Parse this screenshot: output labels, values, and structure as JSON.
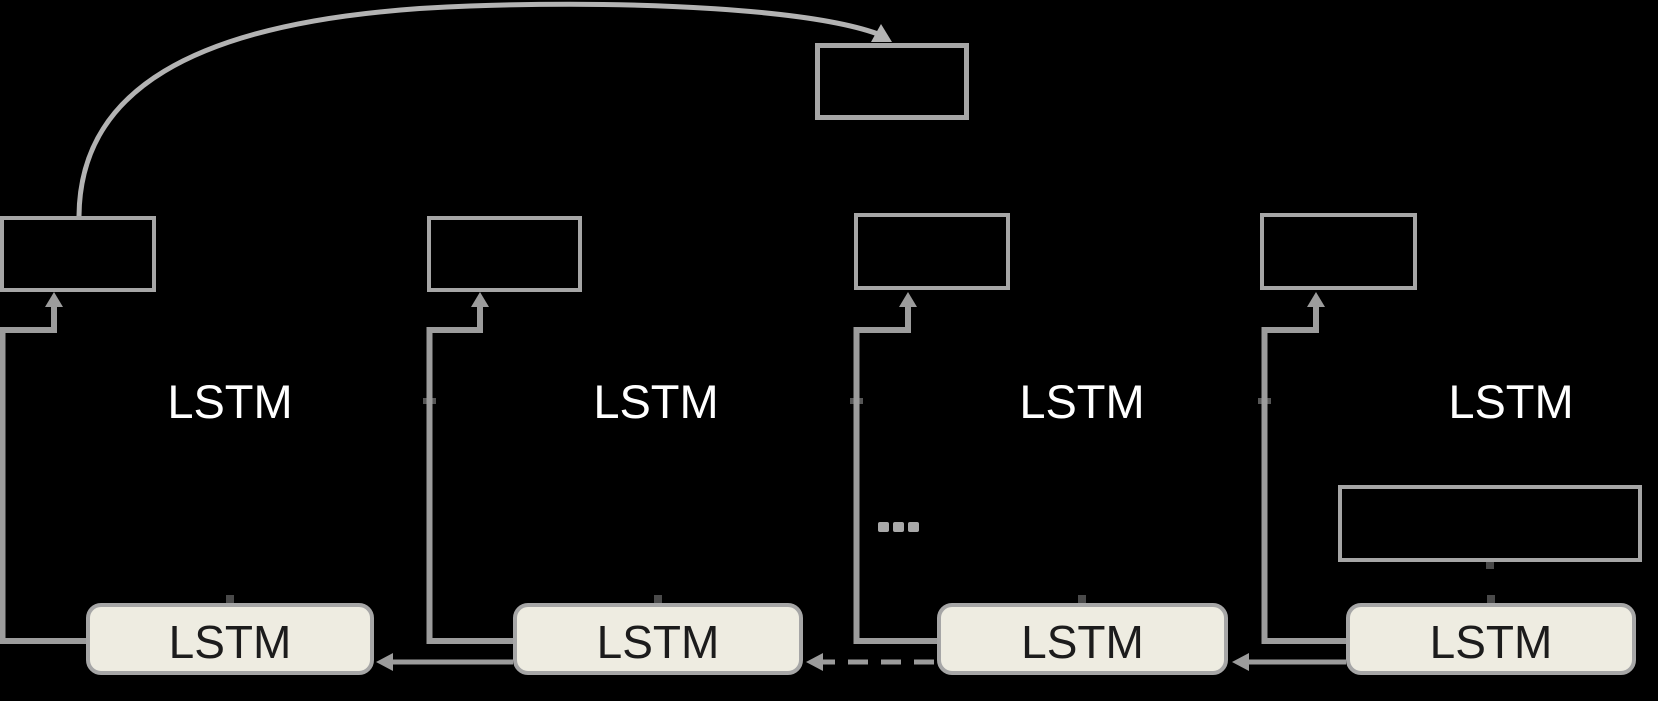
{
  "diagram": {
    "layers": [
      "LSTM",
      "LSTM",
      "LSTM",
      "LSTM"
    ],
    "cells": [
      "LSTM",
      "LSTM",
      "LSTM",
      "LSTM"
    ],
    "ellipsis": "...",
    "colors": {
      "background": "#000000",
      "box_border": "#a6a6a6",
      "wire": "#9c9c9c",
      "curve": "#b3b3b3",
      "cell_fill": "#eeece1",
      "cell_border": "#a6a6a6",
      "cell_text": "#1c1c1c",
      "layer_label_text": "#ffffff",
      "dots": "#a9a9a9"
    }
  }
}
